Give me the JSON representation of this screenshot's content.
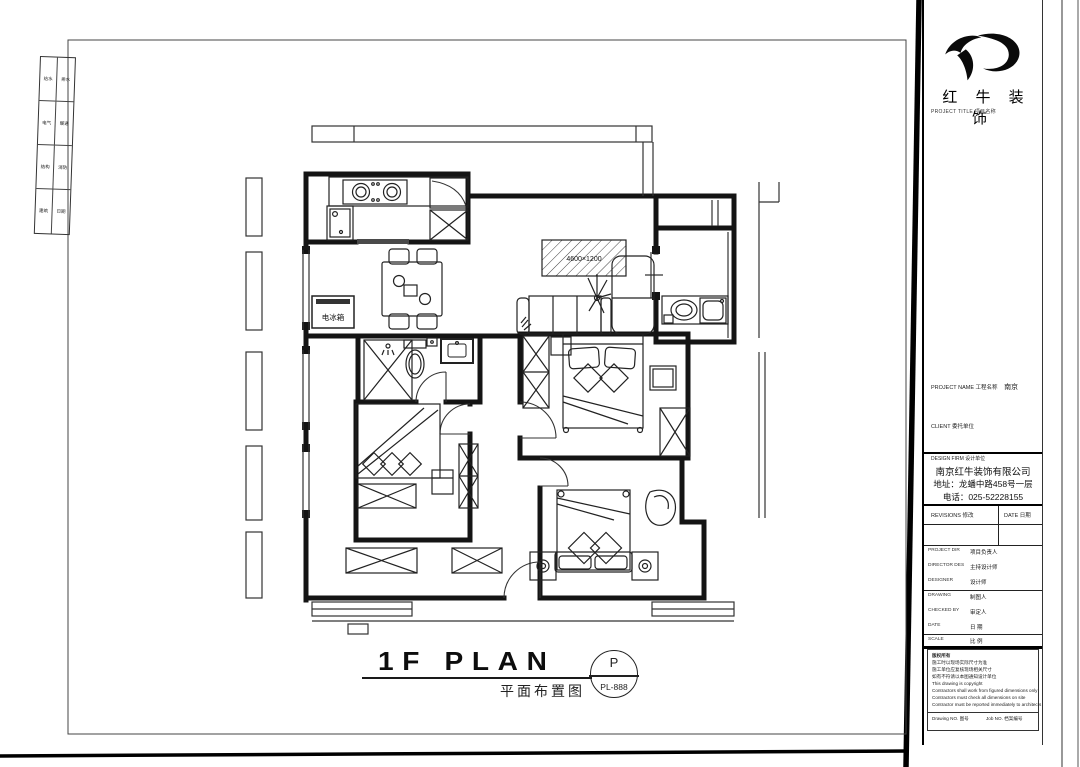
{
  "plan": {
    "fridge_label": "电冰箱",
    "tv_wall_dim": "4600×1200"
  },
  "caption": {
    "title": "1F PLAN",
    "subtitle": "平面布置图",
    "stamp_letter": "P",
    "stamp_number": "PL-888"
  },
  "signature_strip": {
    "cells": [
      [
        "给水",
        "排水"
      ],
      [
        "电气",
        "暖通"
      ],
      [
        "结构",
        "消防"
      ],
      [
        "建筑",
        "日期"
      ]
    ]
  },
  "titleblock": {
    "brand_cn": "红 牛 装 饰",
    "brand_caption": "PROJECT TITLE  项目名称",
    "project": {
      "label": "PROJECT NAME 工程名称",
      "value": "南京"
    },
    "client": {
      "label": "CLIENT  委托单位",
      "value": ""
    },
    "firm": {
      "label": "DESIGN FIRM  设计单位",
      "company": "南京红牛装饰有限公司",
      "address": "地址：龙蟠中路458号一层",
      "phone": "电话：025-52228155"
    },
    "revisions": {
      "col1": "REVISIONS  修改",
      "col2": "DATE  日期"
    },
    "rows": [
      {
        "en": "PROJECT DIR",
        "zh": "项目负责人"
      },
      {
        "en": "DIRECTOR DES",
        "zh": "主持设计师"
      },
      {
        "en": "DESIGNER",
        "zh": "设计师"
      },
      {
        "en": "DRAWING",
        "zh": "制图人"
      },
      {
        "en": "CHECKED BY",
        "zh": "审定人"
      },
      {
        "en": "DATE",
        "zh": "日  期"
      },
      {
        "en": "SCALE",
        "zh": "比  例"
      }
    ],
    "notes": [
      "版权所有",
      "施工时以现场实际尺寸为准",
      "施工单位应复核现场相关尺寸",
      "如有不符请以本图通知设计单位",
      "This drawing is copyright",
      "Contractors shall work from figured dimensions only",
      "Contractors must check all dimensions on site",
      "Contractor must be reported immediately to architects"
    ],
    "footer": {
      "left": "Drawing NO.  图号",
      "right": "Job NO.  档案编号"
    }
  }
}
